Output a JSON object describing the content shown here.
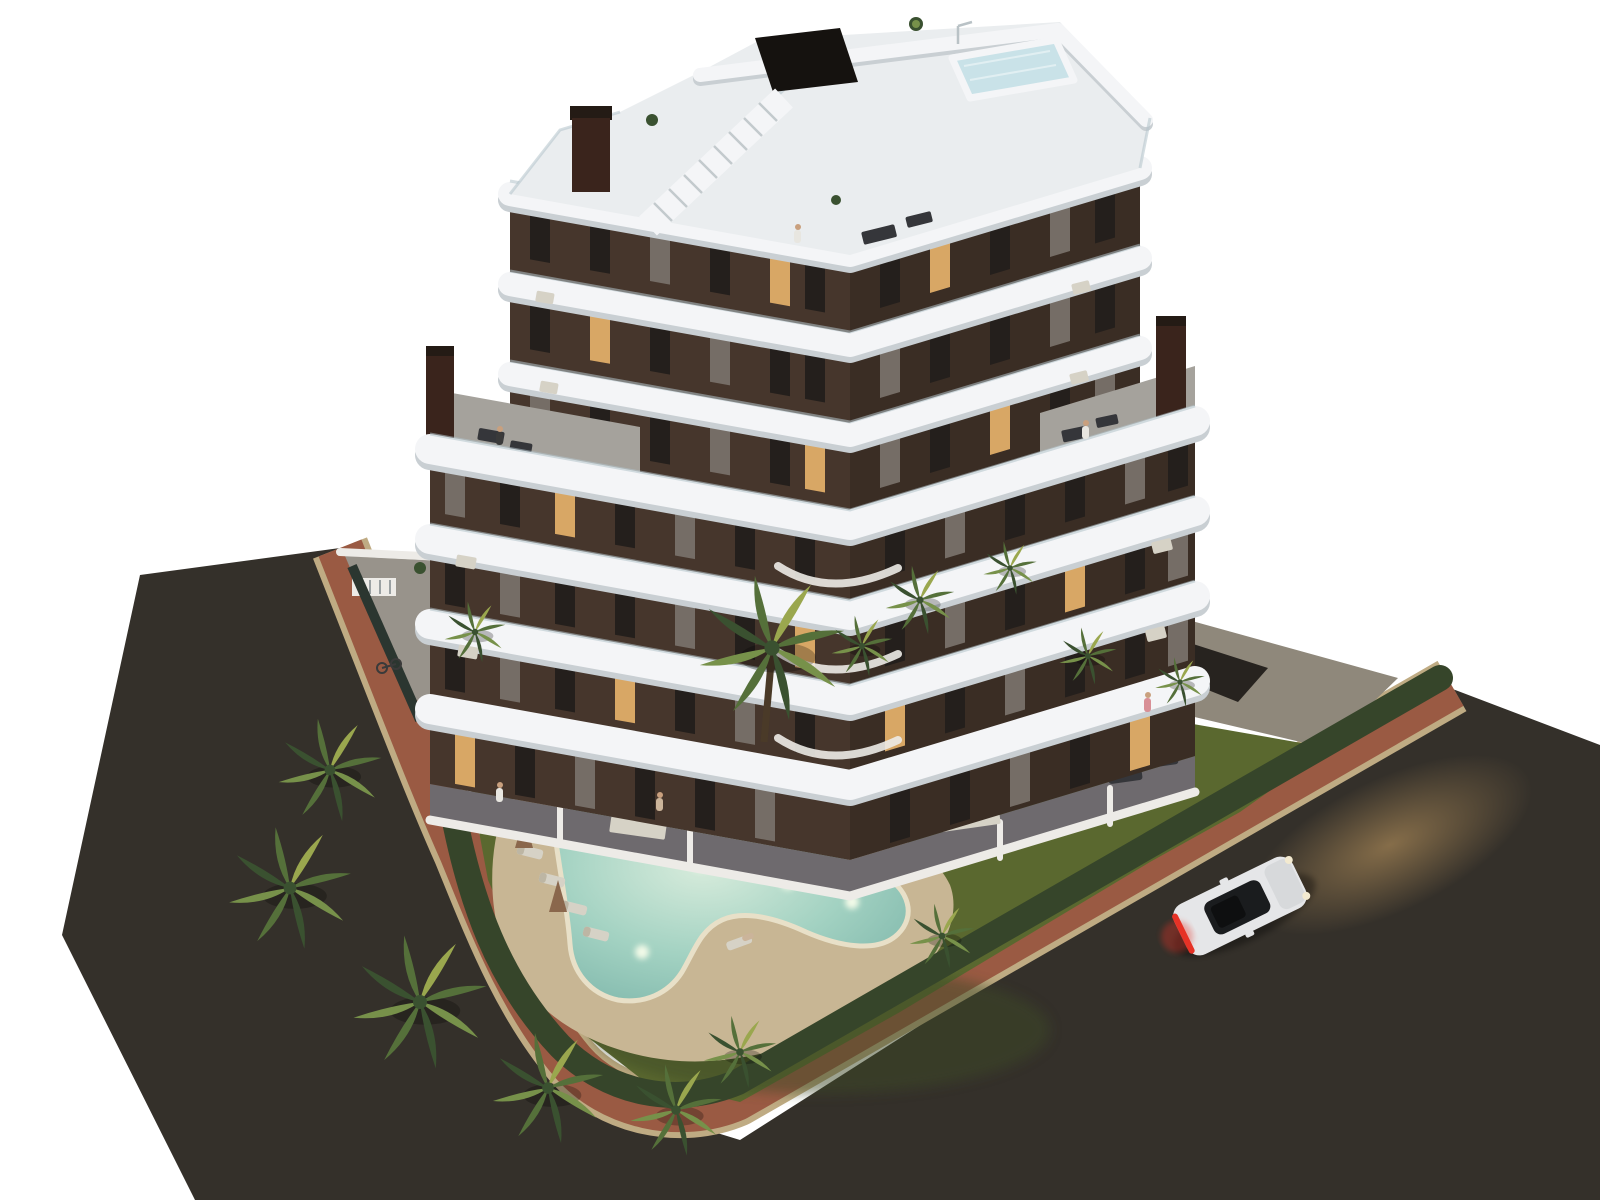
{
  "scene": {
    "type": "architectural-3d-render",
    "description": "Aerial dusk rendering of a modern seven-level apartment building with curving white balcony bands and dark brown facade, rooftop terrace with plunge pool and stair, large wrap-around terraces, landscaped garden with free-form lit swimming pool, sun loungers with furled parasols, palm trees, perimeter hedge, red brick sidewalk wrapping the corner plot, dark asphalt streets and a white sports car driving with headlights on",
    "building": {
      "floors_visible": 7,
      "style": "wavy white balcony slabs over dark brown facade",
      "rooftop": [
        "plunge-pool",
        "staircase",
        "chimneys",
        "outdoor-shower",
        "lounge-furniture"
      ]
    },
    "garden": {
      "swimming_pool_shape": "free-form boomerang with underwater lights",
      "underwater_lights": 4,
      "sun_loungers": 5,
      "parasols_furled": 2,
      "palm_trees": 14,
      "island_planting_bed": 1
    },
    "street": {
      "cars": 1,
      "car_state": "headlights on, red taillights glowing",
      "sidewalk_material": "red brick with stone curb",
      "road_material": "dark asphalt"
    }
  },
  "colors": {
    "background": "#ffffff",
    "road": "#34302a",
    "sidewalk_brick": "#9a5a43",
    "sidewalk_curb": "#bfab83",
    "driveway": "#8f887b",
    "patio": "#98938b",
    "lawn": "#5a682f",
    "lawn_dark": "#3c4a26",
    "lawn_lit": "#8a973f",
    "hedge": "#36452a",
    "fence": "#2b3630",
    "sand": "#c8b694",
    "pool_light": "#d8ecdc",
    "pool_mid": "#a3d2c2",
    "pool_deep": "#7fb7ab",
    "pool_glow": "#f2fae8",
    "facade_left": "#46362c",
    "facade_right": "#3a2d24",
    "window_dark": "#241f1c",
    "window_curtain": "#756d66",
    "window_lit": "#d8a765",
    "band_white": "#f4f5f7",
    "band_shadow": "#c9cfd3",
    "glass": "#b3c3ca",
    "deck": "#a5a29c",
    "terrace": "#6e6a6e",
    "wall": "#edebe7",
    "roof": "#eaedef",
    "chimney": "#241b15",
    "chimney_brown": "#3a241c",
    "bulkhead": "#15120f",
    "rtpool_water": "#c9e2e8",
    "trunk": "#4a3a28",
    "frond_a": "#55703a",
    "frond_b": "#77914a",
    "frond_dark": "#3a5130",
    "frond_lit": "#9aa74e",
    "umbrella": "#8a674c",
    "furn_light": "#d6d2c6",
    "furn_dark": "#35363a",
    "table_wood": "#8a5a36",
    "rock": "#8d8d85",
    "car_body": "#e5e6e8",
    "car_roof": "#1a1c1e",
    "car_tail": "#e63226",
    "car_glow": "#c89f63",
    "person_white": "#e8e6e0",
    "person_pink": "#d88f96",
    "person_beige": "#cbb49a",
    "person_dark": "#3a3a3a",
    "skin": "#c9a07e"
  }
}
